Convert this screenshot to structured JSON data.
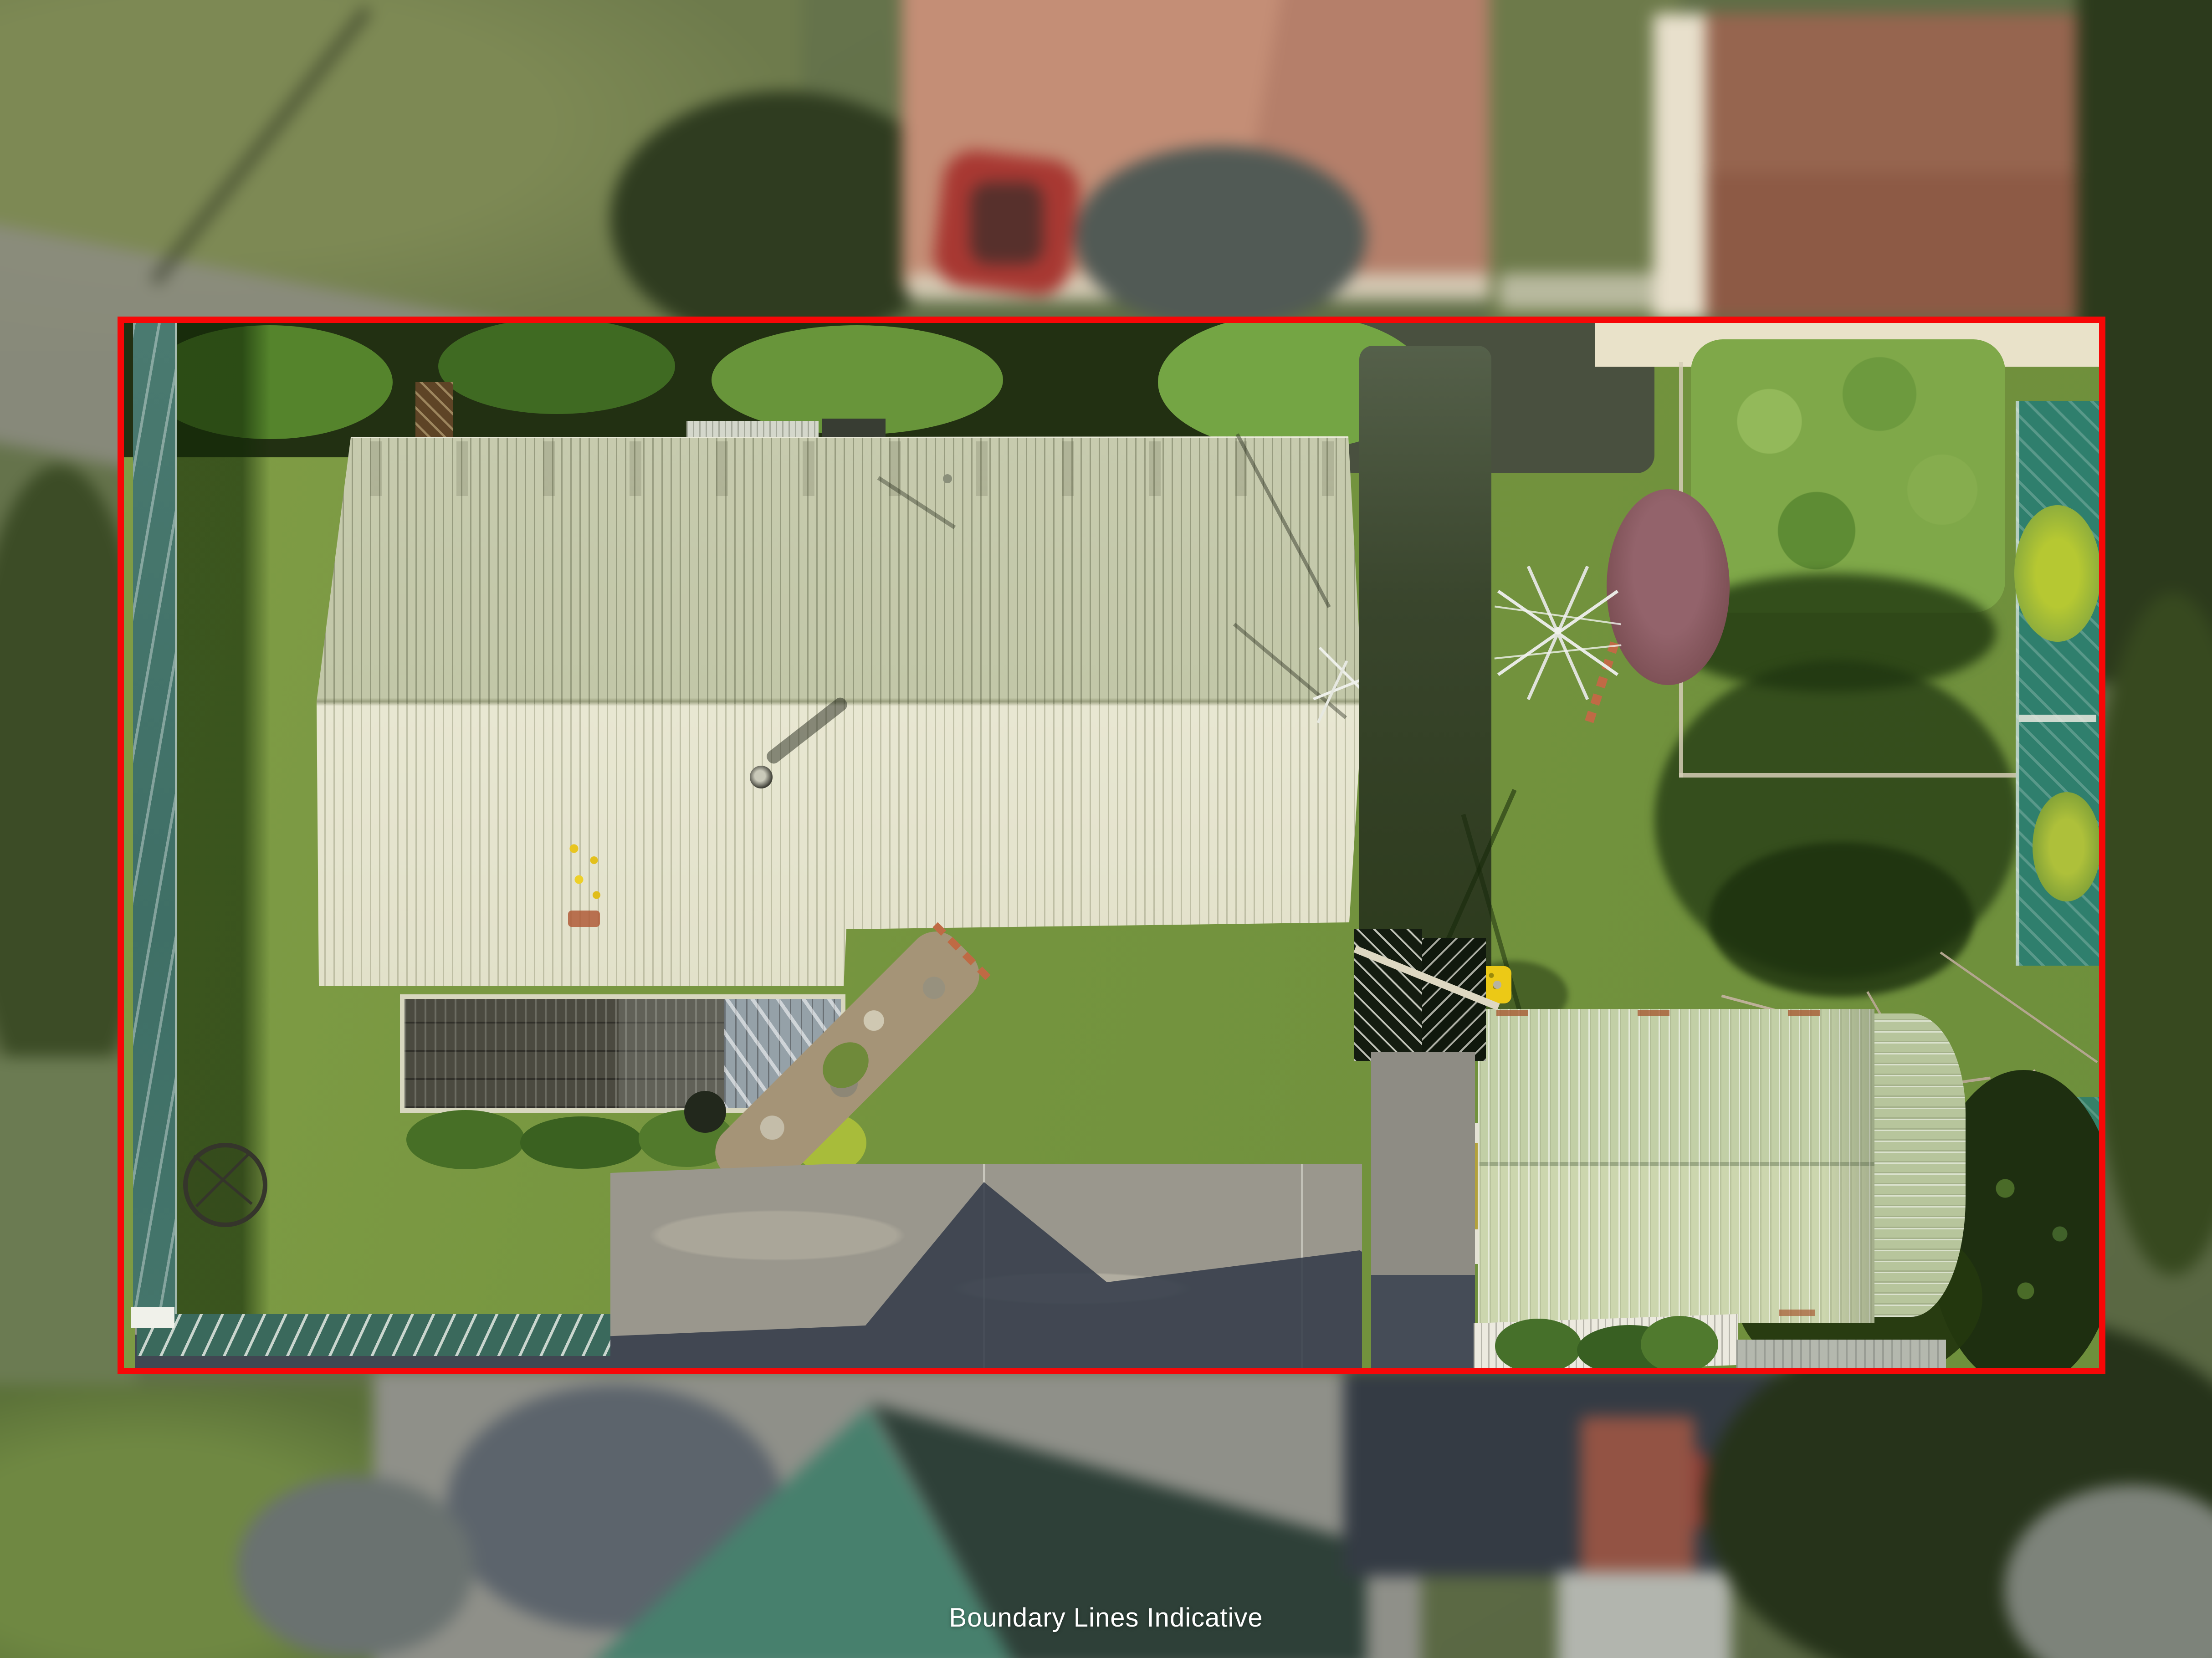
{
  "caption": {
    "text": "Boundary Lines Indicative",
    "color": "#ffffff"
  },
  "boundary": {
    "shape": "rectangle",
    "color": "#f70707"
  },
  "palette": {
    "lawn_green": "#74943e",
    "lawn_shadow": "#2c4a16",
    "main_roof_north": "#c5c9ac",
    "main_roof_south": "#e4e3cd",
    "garage_roof": "#c2cfa6",
    "pergola_dark": "#4b4a40",
    "teal_fence": "#3f6f66",
    "driveway_concrete": "#9a978d",
    "cast_shadow_blue": "#3c4350",
    "hedge_dark": "#223012",
    "neighbour_roof_salmon": "#c08a72",
    "neighbour_roof_teal": "#3e6f60",
    "yellow_bin": "#ecc916"
  }
}
